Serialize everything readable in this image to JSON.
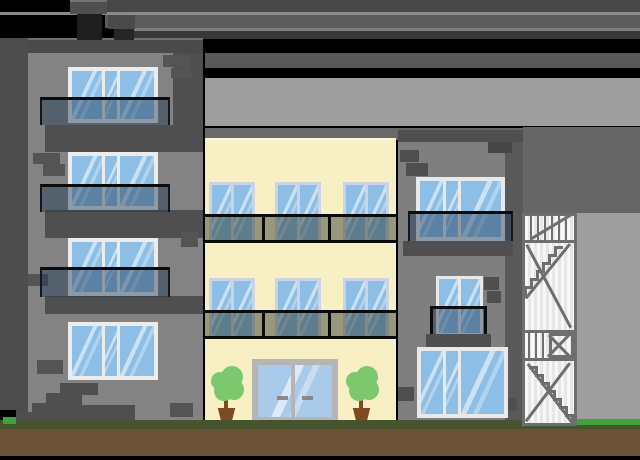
{
  "scene": {
    "type": "flat vector illustration",
    "subject": "Three apartment buildings: dark gray block at left, cream mid-rise in center with glass entrance and potted trees, gray building at right with external fire-escape staircase; layered gray sky bands, grass and soil ground on transparent (black) canvas",
    "buildings": [
      {
        "id": "left",
        "facade_color": "#838383",
        "floors": 4,
        "windows": 4,
        "glass_balconies": 3,
        "chimneys": 2,
        "entry_steps": true
      },
      {
        "id": "center",
        "facade_color": "#f8efc4",
        "window_rows": 2,
        "windows_per_row": 3,
        "balcony_bands": 2,
        "glass_door": true,
        "potted_trees": 2
      },
      {
        "id": "right",
        "facade_color": "#7f7f7f",
        "windows": 3,
        "glass_balcony": 1,
        "railing_balcony": 1
      }
    ],
    "ground": {
      "grass": true,
      "soil": true,
      "bright_grass_patches": 2
    }
  },
  "colors": {
    "transparent_bg": "#000000",
    "sky_band_dark": "#484848",
    "sky_band_mid": "#5c5c5c",
    "sky_band_darker": "#383838",
    "sky_band_gray": "#595959",
    "sky_light_gray": "#9e9e9e",
    "sky_mid_gray": "#696969",
    "sky_block": "#666666",
    "highlight_line": "#8a8a8a",
    "left_facade": "#838383",
    "right_facade": "#7f7f7f",
    "center_facade": "#f8efc4",
    "center_facade_highlight": "#fcf6d8",
    "structure_dark": "#4f4f4f",
    "roof": "#4a4a4a",
    "chimney_dark": "#1e1e1e",
    "brick": "#545454",
    "window_frame_white": "#ececec",
    "window_frame_lavender": "#ccd3e2",
    "glass_blue": "#8cbee6",
    "glass_light_blue": "#a9cbe9",
    "balcony_black": "#0b0b0b",
    "door_frame": "#b5b5b5",
    "door_handle": "#8a8a8a",
    "tree_foliage": "#7cc96d",
    "tree_trunk_pot": "#7d4a22",
    "grass": "#47552f",
    "grass_bright": "#3fa339",
    "soil": "#6b5138",
    "stair_frame": "#6e6e6e"
  },
  "fire_escape": {
    "color": "#6e6e6e",
    "bars": [
      {
        "x": 530,
        "y": 216,
        "h": 24,
        "count": 6,
        "gap": 7
      },
      {
        "x": 528,
        "y": 333,
        "h": 25,
        "count": 4,
        "gap": 7
      }
    ],
    "lines": [
      {
        "x": 572,
        "y": 216,
        "len": 47,
        "deg": 149
      },
      {
        "x": 571,
        "y": 245,
        "len": 70,
        "deg": 129
      },
      {
        "x": 528,
        "y": 244,
        "len": 94,
        "deg": 62
      },
      {
        "x": 550,
        "y": 334,
        "len": 33,
        "deg": 46
      },
      {
        "x": 572,
        "y": 334,
        "len": 33,
        "deg": 134
      },
      {
        "x": 571,
        "y": 364,
        "len": 73,
        "deg": 127
      },
      {
        "x": 529,
        "y": 363,
        "len": 75,
        "deg": 53
      }
    ],
    "flights": [
      {
        "x": 563,
        "y": 246,
        "dir": -1,
        "steps": 6,
        "run": 6,
        "rise": 8
      },
      {
        "x": 529,
        "y": 366,
        "dir": 1,
        "steps": 7,
        "run": 6,
        "rise": 8
      }
    ]
  }
}
